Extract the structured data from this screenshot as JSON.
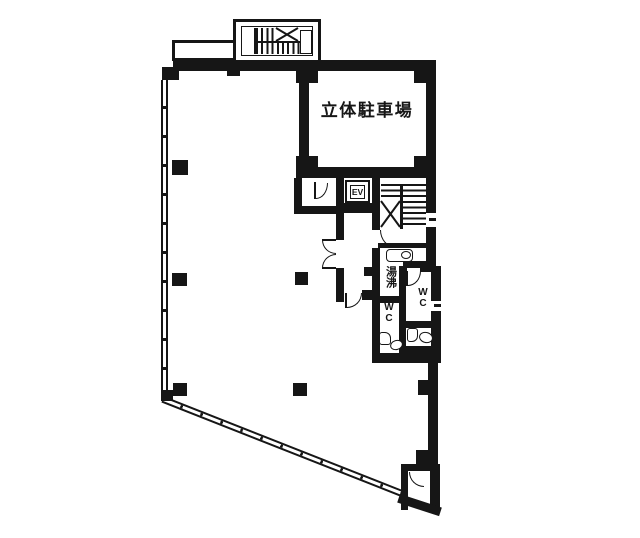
{
  "drawing": {
    "type": "building-floor-plan",
    "labels": {
      "parking": "立体駐車場",
      "elevator": "EV",
      "water_heating": "湯沸",
      "wc_right": "WC",
      "wc_left": "WC"
    },
    "colors": {
      "ink": "#161616",
      "paper": "#ffffff"
    }
  }
}
